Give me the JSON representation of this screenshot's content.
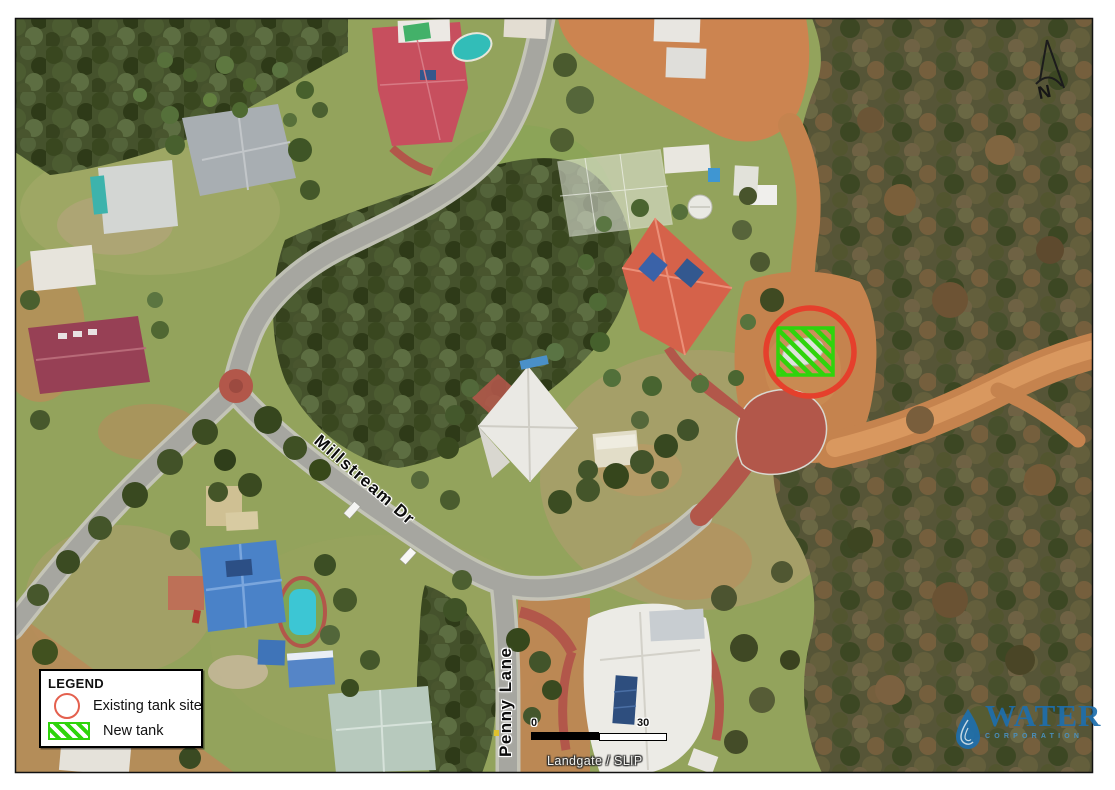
{
  "map": {
    "street_labels": [
      {
        "name": "Millstream Dr"
      },
      {
        "name": "Penny Lane"
      }
    ],
    "north_arrow_label": "N"
  },
  "legend": {
    "title": "LEGEND",
    "items": [
      {
        "label": "Existing tank site",
        "symbol": "red-circle-outline",
        "color": "#e4604e"
      },
      {
        "label": "New tank",
        "symbol": "green-hatched-square",
        "color": "#2fd40c"
      }
    ]
  },
  "scale_bar": {
    "start_label": "0",
    "end_label": "30"
  },
  "attribution": "Landgate / SLIP",
  "logo": {
    "name": "WATER",
    "subtitle": "CORPORATION",
    "color": "#1e6fad"
  },
  "markers": {
    "existing_tank_site": {
      "shape": "circle",
      "color": "#e5402c"
    },
    "new_tank": {
      "shape": "hatched-square",
      "color": "#2fd40c"
    }
  }
}
